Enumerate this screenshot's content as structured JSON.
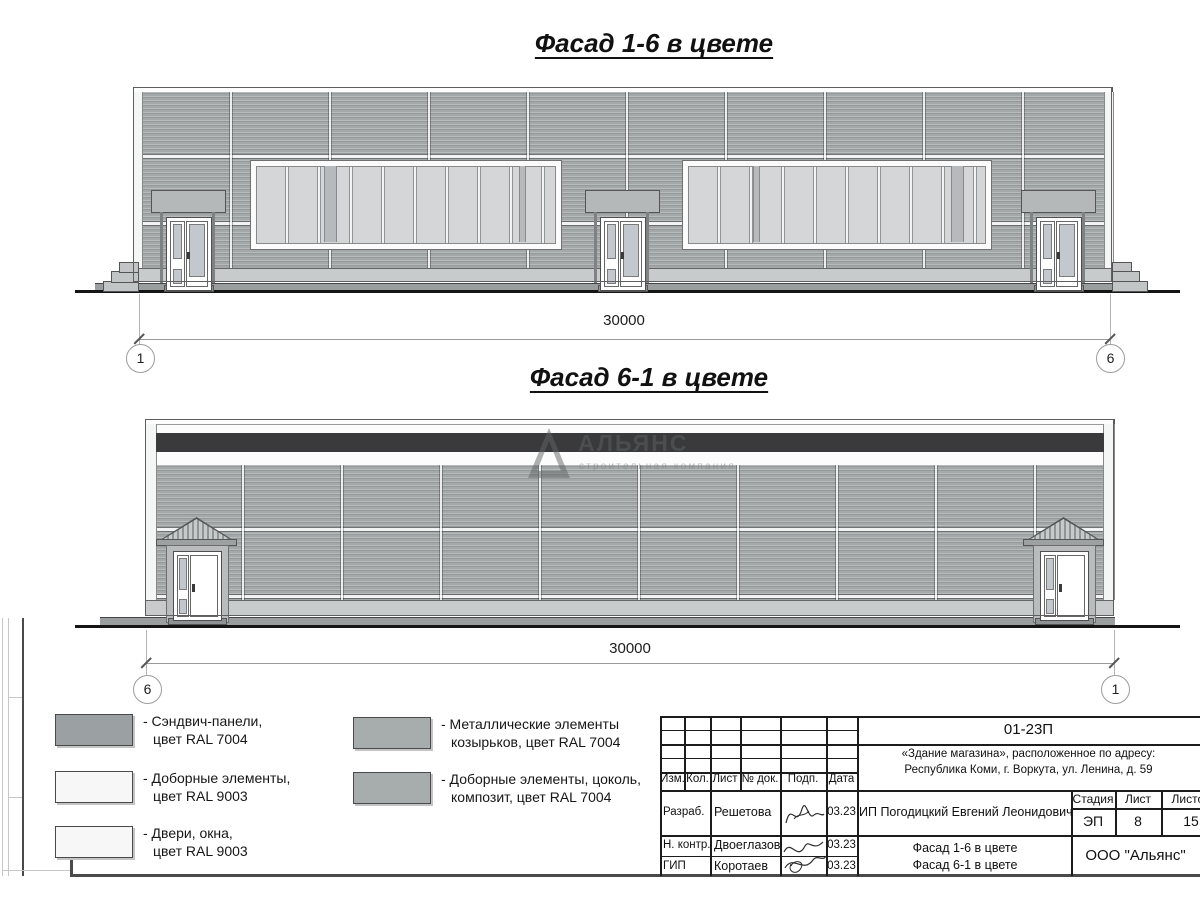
{
  "facade1": {
    "title": "Фасад 1-6 в цвете",
    "dimension": "30000",
    "axis_left": "1",
    "axis_right": "6"
  },
  "facade2": {
    "title": "Фасад 6-1 в цвете",
    "dimension": "30000",
    "axis_left": "6",
    "axis_right": "1"
  },
  "watermark": {
    "name": "АЛЬЯНС",
    "tagline": "строительная компания"
  },
  "colors": {
    "wall_sandwich_panels": "#a3a8a8",
    "dark_composite_band": "#3a3a3c",
    "window_glass": "#d4d6d8",
    "canopy_metal": "#b4b8b8",
    "ral7004_swatch": "#9ba0a2",
    "ral9003_swatch": "#f7f7f7",
    "ral7004_metal_swatch": "#a7acac"
  },
  "legend": {
    "items_col1": [
      {
        "swatch_color": "#9ba0a2",
        "line1": "- Сэндвич-панели,",
        "line2": "цвет RAL 7004"
      },
      {
        "swatch_color": "#f7f7f7",
        "line1": "- Доборные элементы,",
        "line2": "цвет RAL 9003"
      },
      {
        "swatch_color": "#f7f7f7",
        "line1": "- Двери, окна,",
        "line2": "цвет RAL 9003"
      }
    ],
    "items_col2": [
      {
        "swatch_color": "#a7acac",
        "line1": "- Металлические элементы",
        "line2": "козырьков, цвет RAL 7004"
      },
      {
        "swatch_color": "#a7acac",
        "line1": "- Доборные элементы, цоколь,",
        "line2": "композит, цвет RAL 7004"
      }
    ]
  },
  "titleblock": {
    "doc_code": "01-23П",
    "address_line1": "«Здание магазина», расположенное по адресу:",
    "address_line2": "Республика Коми, г. Воркута, ул. Ленина, д. 59",
    "col_izm": "Изм.",
    "col_kol": "Кол.",
    "col_list": "Лист",
    "col_doc": "№ док.",
    "col_podp": "Подп.",
    "col_data": "Дата",
    "row1_role": "Разраб.",
    "row1_name": "Решетова",
    "row1_date": "03.23",
    "row2_role": "Н. контр.",
    "row2_name": "Двоеглазов",
    "row2_date": "03.23",
    "row3_role": "ГИП",
    "row3_name": "Коротаев",
    "row3_date": "03.23",
    "client": "ИП Погодицкий Евгений Леонидович",
    "stage_label": "Стадия",
    "sheet_label": "Лист",
    "sheets_label": "Листов",
    "stage": "ЭП",
    "sheet": "8",
    "sheets": "15",
    "sheet_title_line1": "Фасад 1-6 в цвете",
    "sheet_title_line2": "Фасад 6-1 в цвете",
    "company": "ООО \"Альянс\""
  }
}
